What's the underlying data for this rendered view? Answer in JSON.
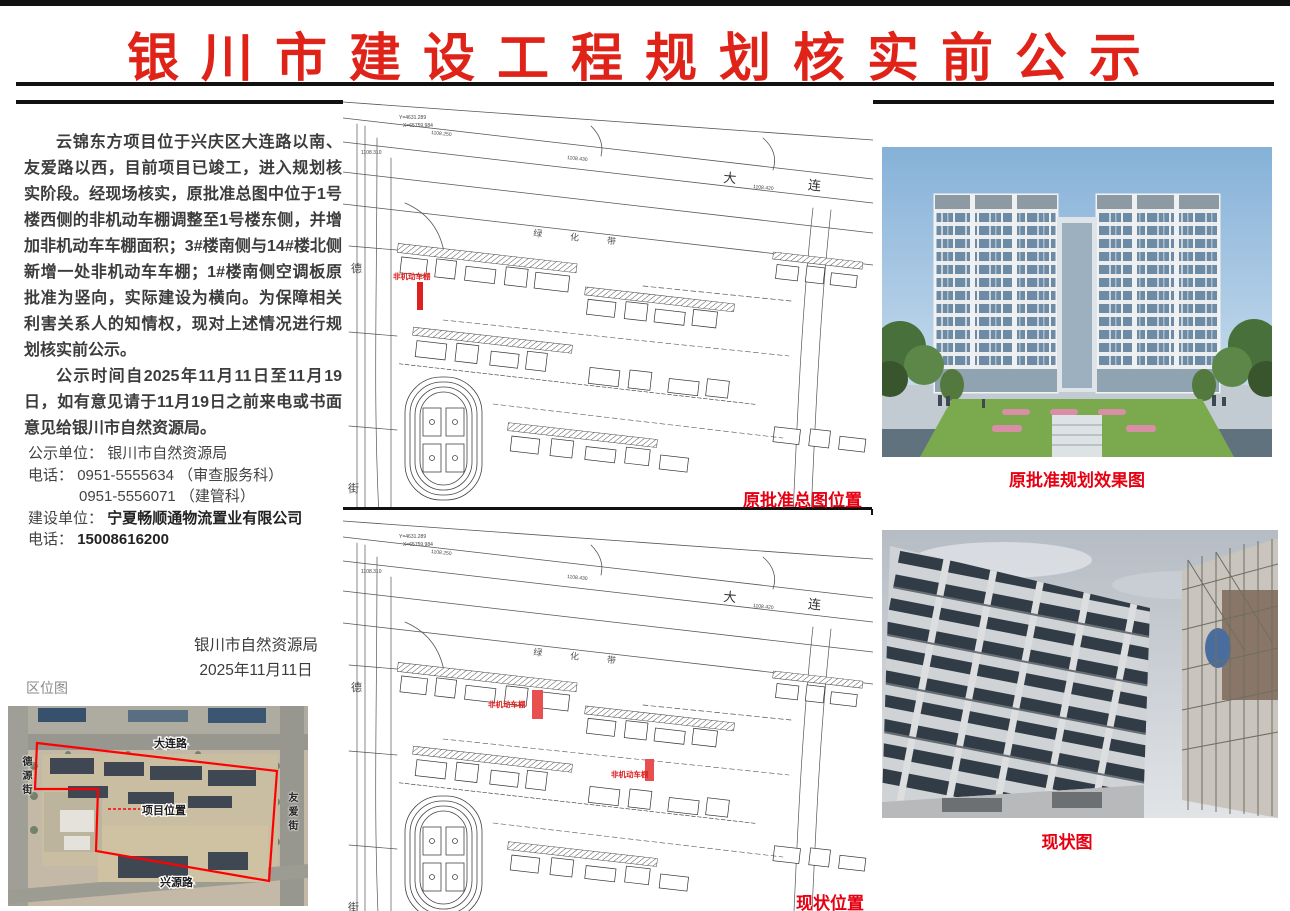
{
  "page": {
    "title": "银川市建设工程规划核实前公示"
  },
  "notice": {
    "paragraph1": "云锦东方项目位于兴庆区大连路以南、友爱路以西，目前项目已竣工，进入规划核实阶段。经现场核实，原批准总图中位于1号楼西侧的非机动车棚调整至1号楼东侧，并增加非机动车车棚面积；3#楼南侧与14#楼北侧新增一处非机动车车棚；1#楼南侧空调板原批准为竖向，实际建设为横向。为保障相关利害关系人的知情权，现对上述情况进行规划核实前公示。",
    "paragraph2": "公示时间自2025年11月11日至11月19日，如有意见请于11月19日之前来电或书面意见给银川市自然资源局。"
  },
  "contact": {
    "publicity_unit_label": "公示单位：",
    "publicity_unit": "银川市自然资源局",
    "phone_label": "电话：",
    "phone1": "0951-5555634 （审查服务科）",
    "phone2": "0951-5556071 （建管科）",
    "builder_label": "建设单位：",
    "builder": "宁夏畅顺通物流置业有限公司",
    "phone3_label": "电话：",
    "phone3": "15008616200"
  },
  "signature": {
    "org": "银川市自然资源局",
    "date": "2025年11月11日"
  },
  "location_map": {
    "label": "区位图",
    "road_top": "大连路",
    "road_left": "德源街",
    "road_right": "友爱街",
    "road_bottom": "兴源路",
    "site_label": "项目位置",
    "boundary_color": "#ff0000"
  },
  "site_plan": {
    "road_name": "大连",
    "green_belt": "绿化带",
    "street_top": "德",
    "street_bottom": "街",
    "coord1": "Y=4631.289",
    "coord2": "X=65759.984",
    "dim1": "1108.250",
    "dim2": "1108.430",
    "dim3": "1108.310",
    "dim4": "1108.420"
  },
  "plan1": {
    "caption": "原批准总图位置",
    "red_label": "非机动车棚"
  },
  "plan2": {
    "caption": "现状位置",
    "red_label1": "非机动车棚",
    "red_label2": "非机动车棚"
  },
  "right_column": {
    "rendering_caption": "原批准规划效果图",
    "photo_caption": "现状图"
  },
  "colors": {
    "title_red": "#e02318",
    "caption_red": "#e60012",
    "boundary_red": "#ff0000"
  }
}
